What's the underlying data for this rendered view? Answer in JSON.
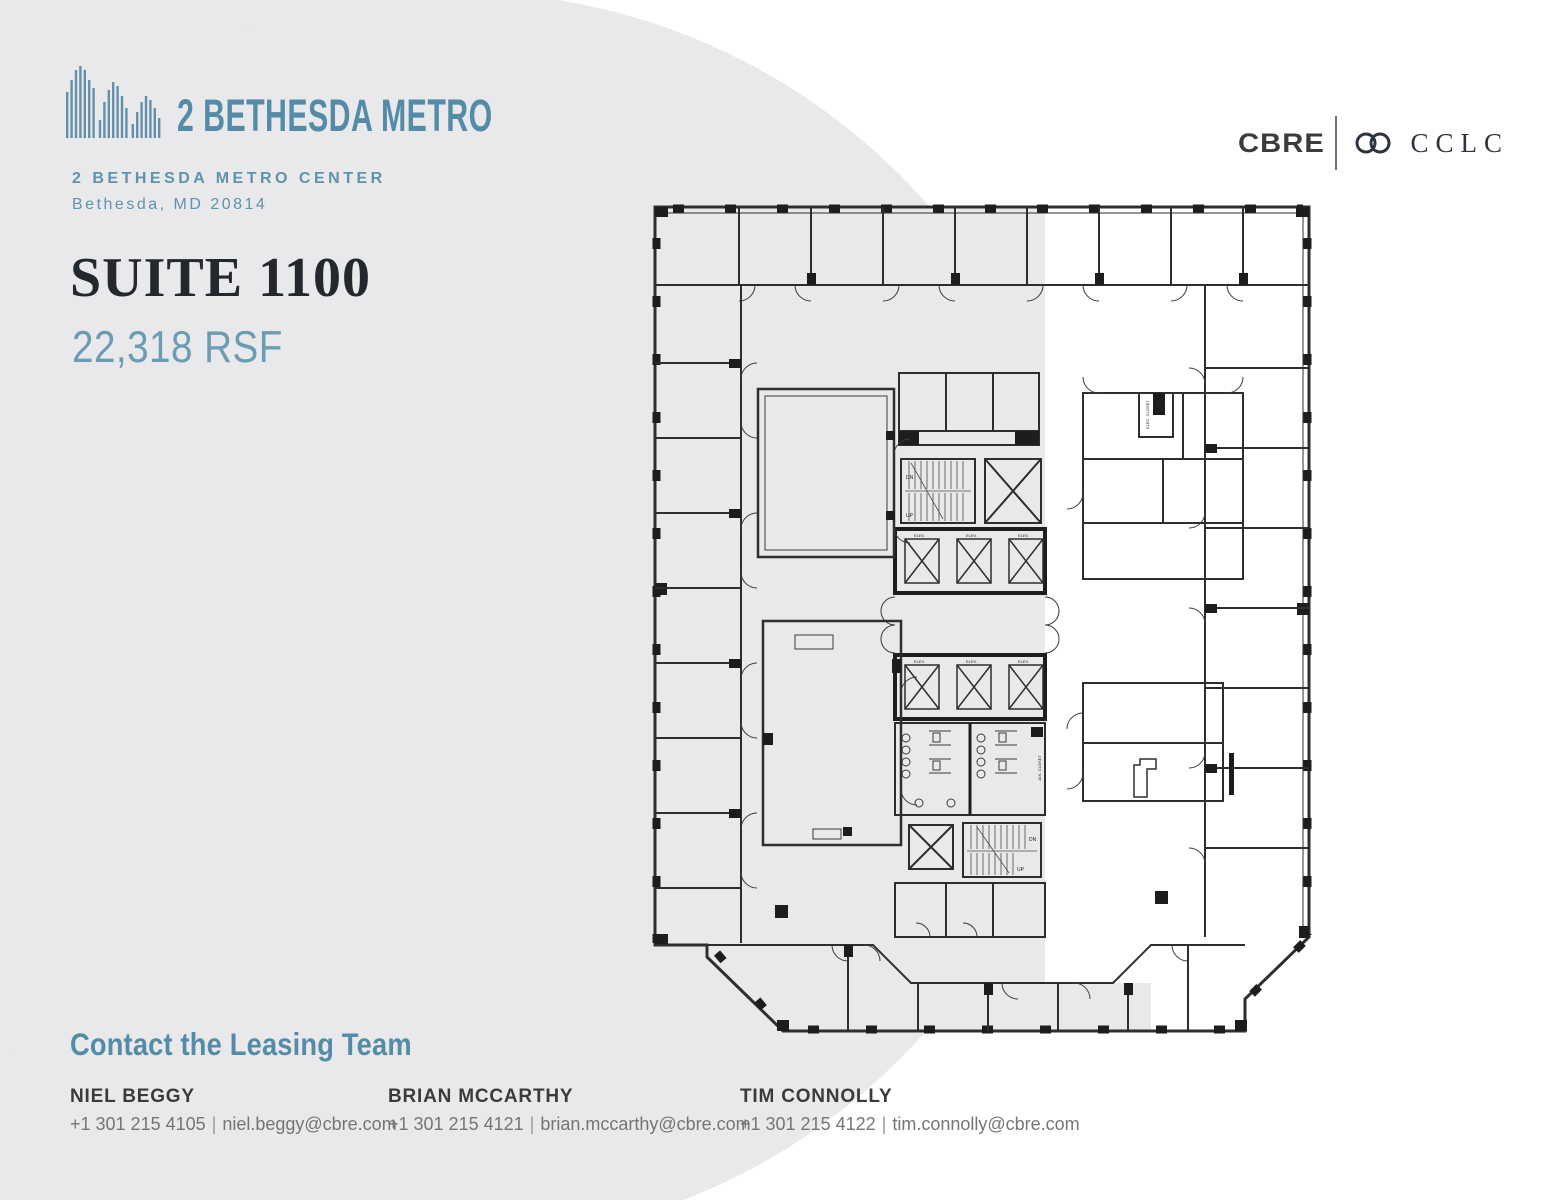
{
  "brand": {
    "building_name": "2 BETHESDA METRO",
    "address_line1": "2 BETHESDA METRO CENTER",
    "address_line2": "Bethesda, MD 20814"
  },
  "suite": {
    "title": "SUITE 1100",
    "area": "22,318 RSF"
  },
  "partners": {
    "cbre": "CBRE",
    "cclc": "CCLC"
  },
  "floorplan": {
    "labels": {
      "elevator": "ELEV.",
      "stair_up": "UP",
      "stair_down": "DN",
      "elec_closet": "ELEC. CLOSET",
      "jan_closet": "JAN. CLOSET"
    }
  },
  "contact": {
    "heading": "Contact the Leasing Team",
    "divider": "|",
    "people": [
      {
        "name": "NIEL BEGGY",
        "phone": "+1 301 215 4105",
        "email": "niel.beggy@cbre.com"
      },
      {
        "name": "BRIAN MCCARTHY",
        "phone": "+1 301 215 4121",
        "email": "brian.mccarthy@cbre.com"
      },
      {
        "name": "TIM CONNOLLY",
        "phone": "+1 301 215 4122",
        "email": "tim.connolly@cbre.com"
      }
    ]
  },
  "colors": {
    "accent_blue": "#548ca8",
    "light_blue": "#6b9cb2",
    "title_dark": "#23272e",
    "background_gray": "#e9e9ec",
    "wall_dark": "#2e2e2e"
  }
}
